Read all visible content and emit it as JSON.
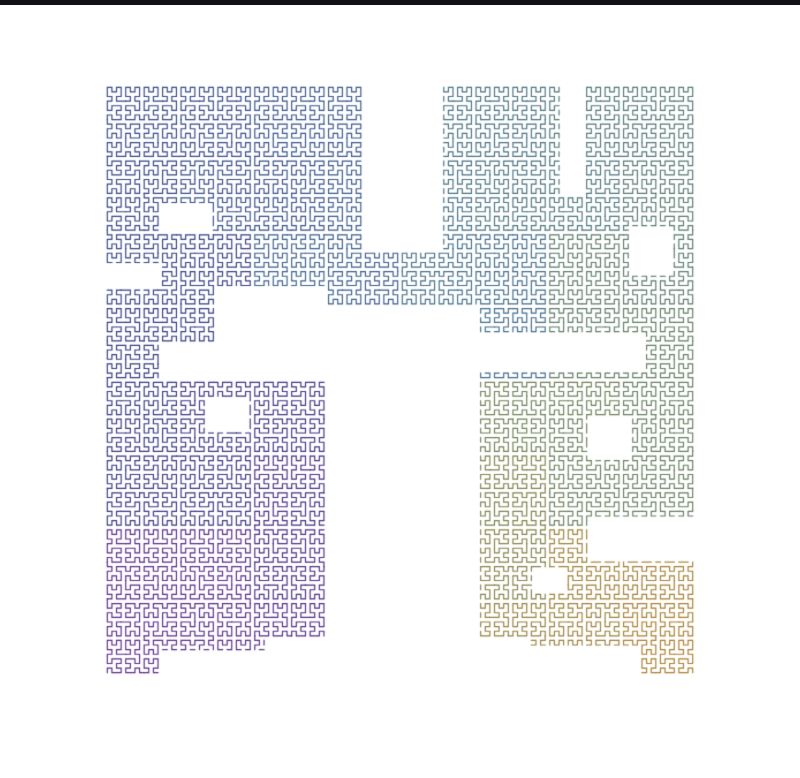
{
  "page": {
    "width": 800,
    "height": 778,
    "background": "#ffffff"
  },
  "top_bar": {
    "color": "#101016",
    "height": 5
  },
  "fractal": {
    "type": "hilbert-curve",
    "order": 7,
    "grid": 128,
    "area": {
      "x": 105,
      "y": 85,
      "size": 590
    },
    "stroke_width": 1.15,
    "line_cap": "square",
    "start_corner": "bottom-left",
    "end_corner": "bottom-right",
    "quadrant_order": "BL-TL-TR-BR",
    "gradient_stops": [
      [
        0.0,
        "#5b2b88"
      ],
      [
        0.13,
        "#472e84"
      ],
      [
        0.27,
        "#333a80"
      ],
      [
        0.4,
        "#37538a"
      ],
      [
        0.52,
        "#3f6a8b"
      ],
      [
        0.62,
        "#4b737e"
      ],
      [
        0.72,
        "#5e7b67"
      ],
      [
        0.82,
        "#6f8056"
      ],
      [
        0.9,
        "#8a8245"
      ],
      [
        1.0,
        "#ab7e2e"
      ]
    ],
    "holes_cell_rects": [
      [
        56,
        0,
        73,
        36
      ],
      [
        48,
        48,
        81,
        128
      ],
      [
        24,
        44,
        48,
        64
      ],
      [
        12,
        56,
        24,
        64
      ],
      [
        0,
        39,
        12,
        44
      ],
      [
        12,
        26,
        23,
        32
      ],
      [
        35,
        120,
        48,
        128
      ],
      [
        81,
        120,
        92,
        128
      ],
      [
        12,
        123,
        35,
        128
      ],
      [
        99,
        0,
        104,
        24
      ],
      [
        114,
        31,
        123,
        41
      ],
      [
        81,
        54,
        117,
        62
      ],
      [
        105,
        72,
        114,
        81
      ],
      [
        105,
        94,
        128,
        103
      ],
      [
        92,
        122,
        116,
        128
      ],
      [
        22,
        68,
        31,
        75
      ],
      [
        93,
        105,
        100,
        110
      ]
    ]
  }
}
